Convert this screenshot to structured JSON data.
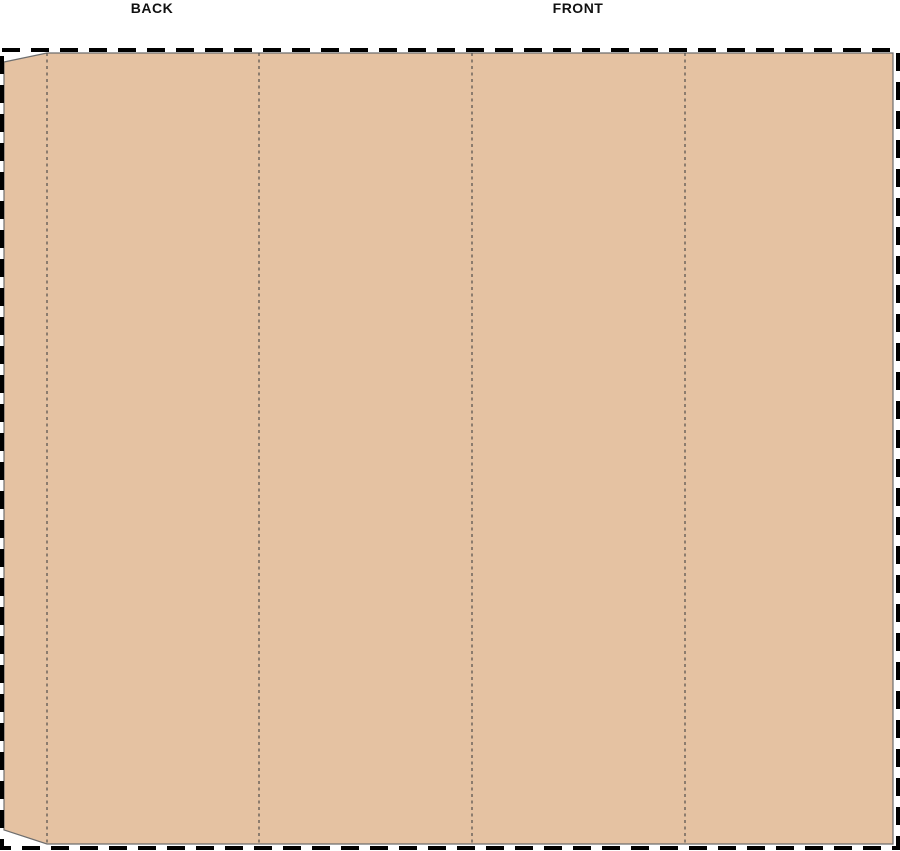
{
  "canvas": {
    "background": "#ffffff"
  },
  "labels": {
    "back": "BACK",
    "front": "FRONT"
  },
  "colors": {
    "panel_fill": "#e5c2a2",
    "panel_outline": "#6e6e6e",
    "cutline": "#000000",
    "foldline": "#524e4b"
  }
}
